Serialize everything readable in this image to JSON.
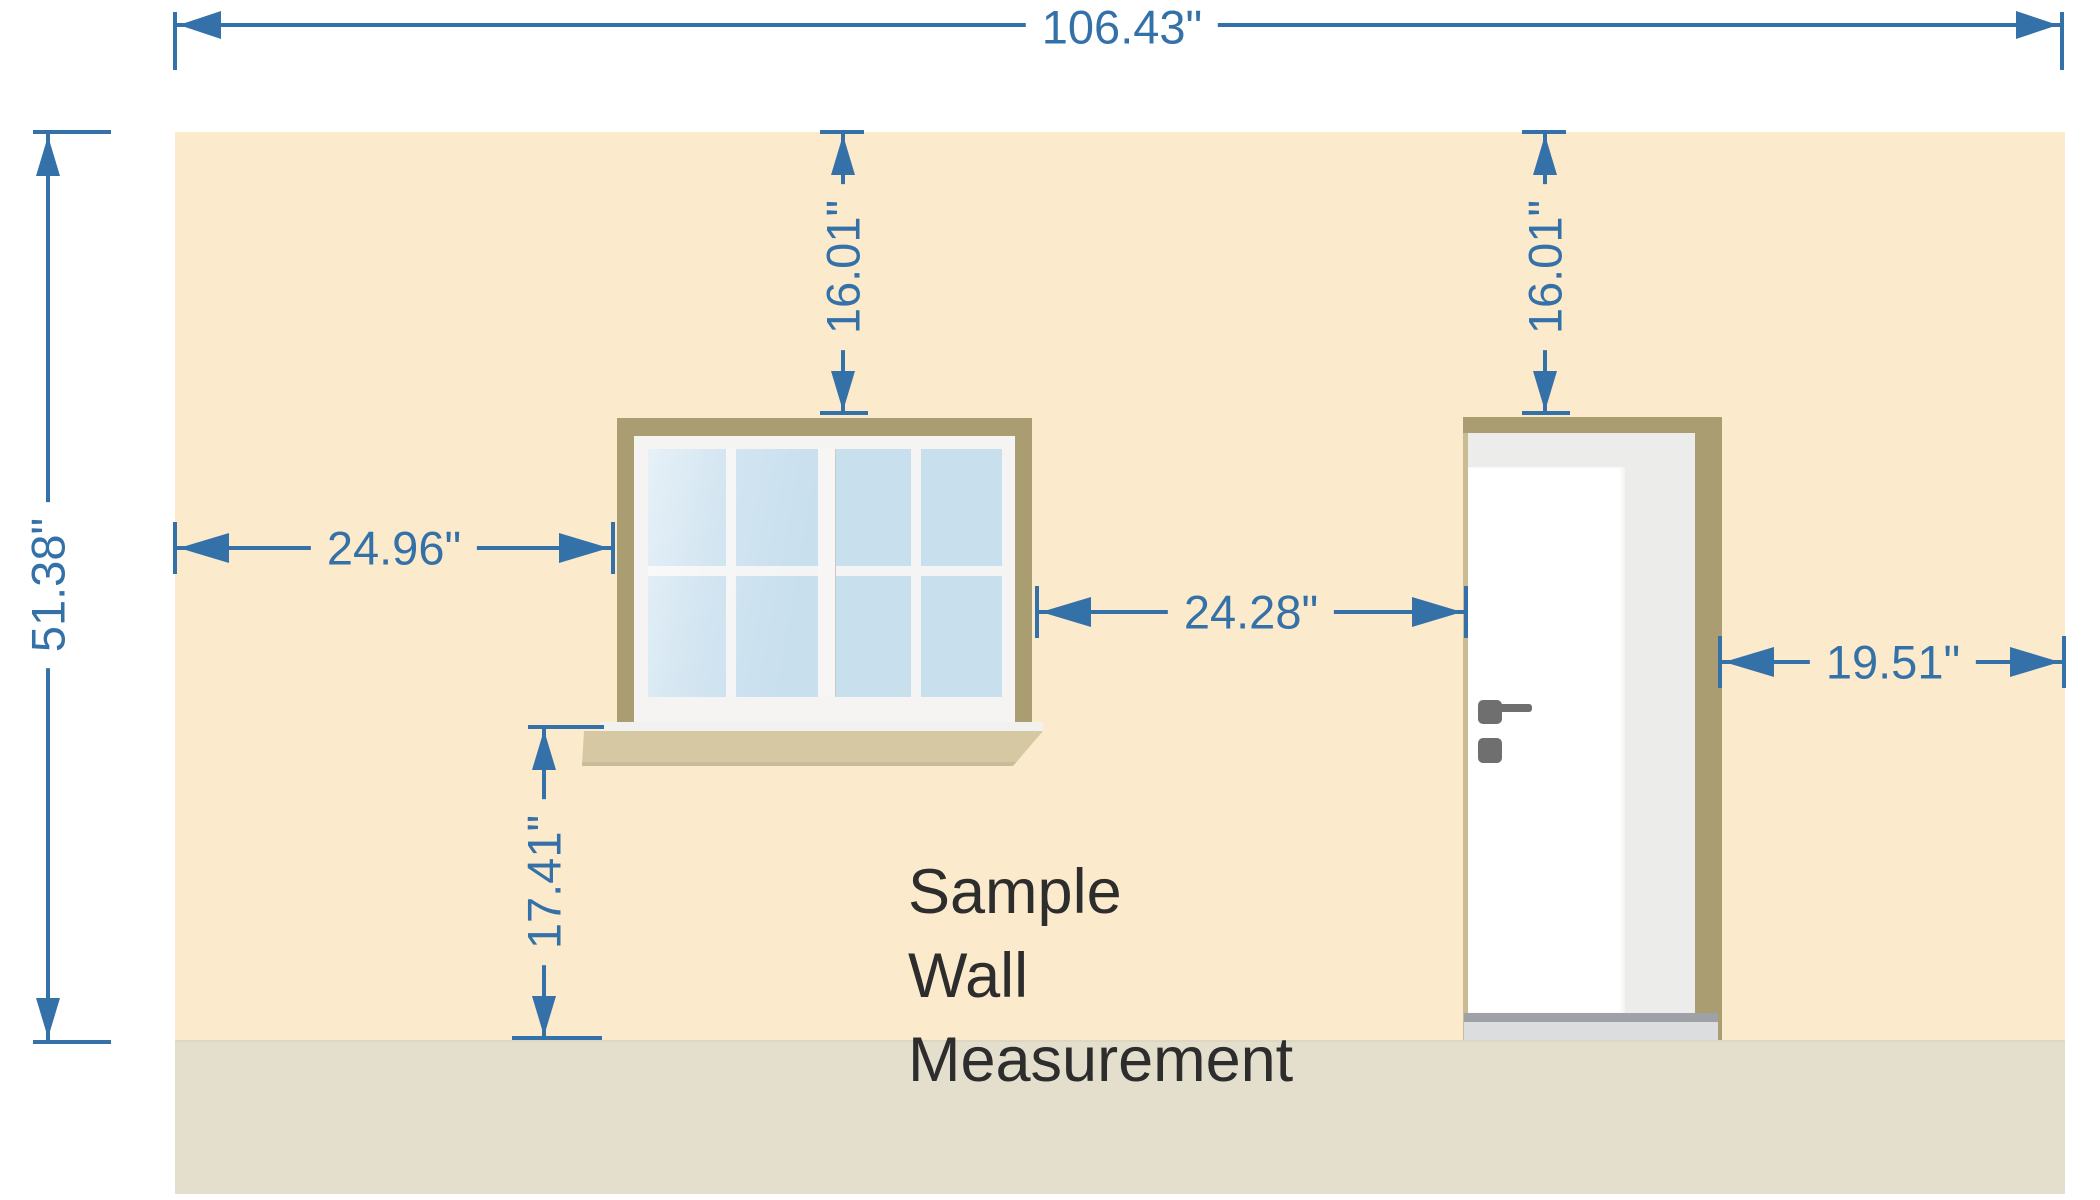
{
  "caption": {
    "lines": [
      "Sample",
      "Wall",
      "Measurement"
    ]
  },
  "dimensions": {
    "total_width": {
      "value": "106.43\""
    },
    "wall_height": {
      "value": "51.38\""
    },
    "window_top_offset": {
      "value": "16.01\""
    },
    "door_top_offset": {
      "value": "16.01\""
    },
    "window_left_offset": {
      "value": "24.96\""
    },
    "window_to_door_gap": {
      "value": "24.28\""
    },
    "door_right_offset": {
      "value": "19.51\""
    },
    "sill_to_floor": {
      "value": "17.41\""
    }
  },
  "colors": {
    "dimension_blue": "#3571a9",
    "wall": "#fbeacb",
    "floor": "#e4decc",
    "trim_tan": "#aa9d71",
    "sill_tan": "#d6c8a2",
    "glass_blue": "#c8dfee",
    "door_white": "#ffffff",
    "jamb_gray": "#ececea",
    "hardware_gray": "#6f6f6f",
    "caption_ink": "#2d2d2d"
  }
}
